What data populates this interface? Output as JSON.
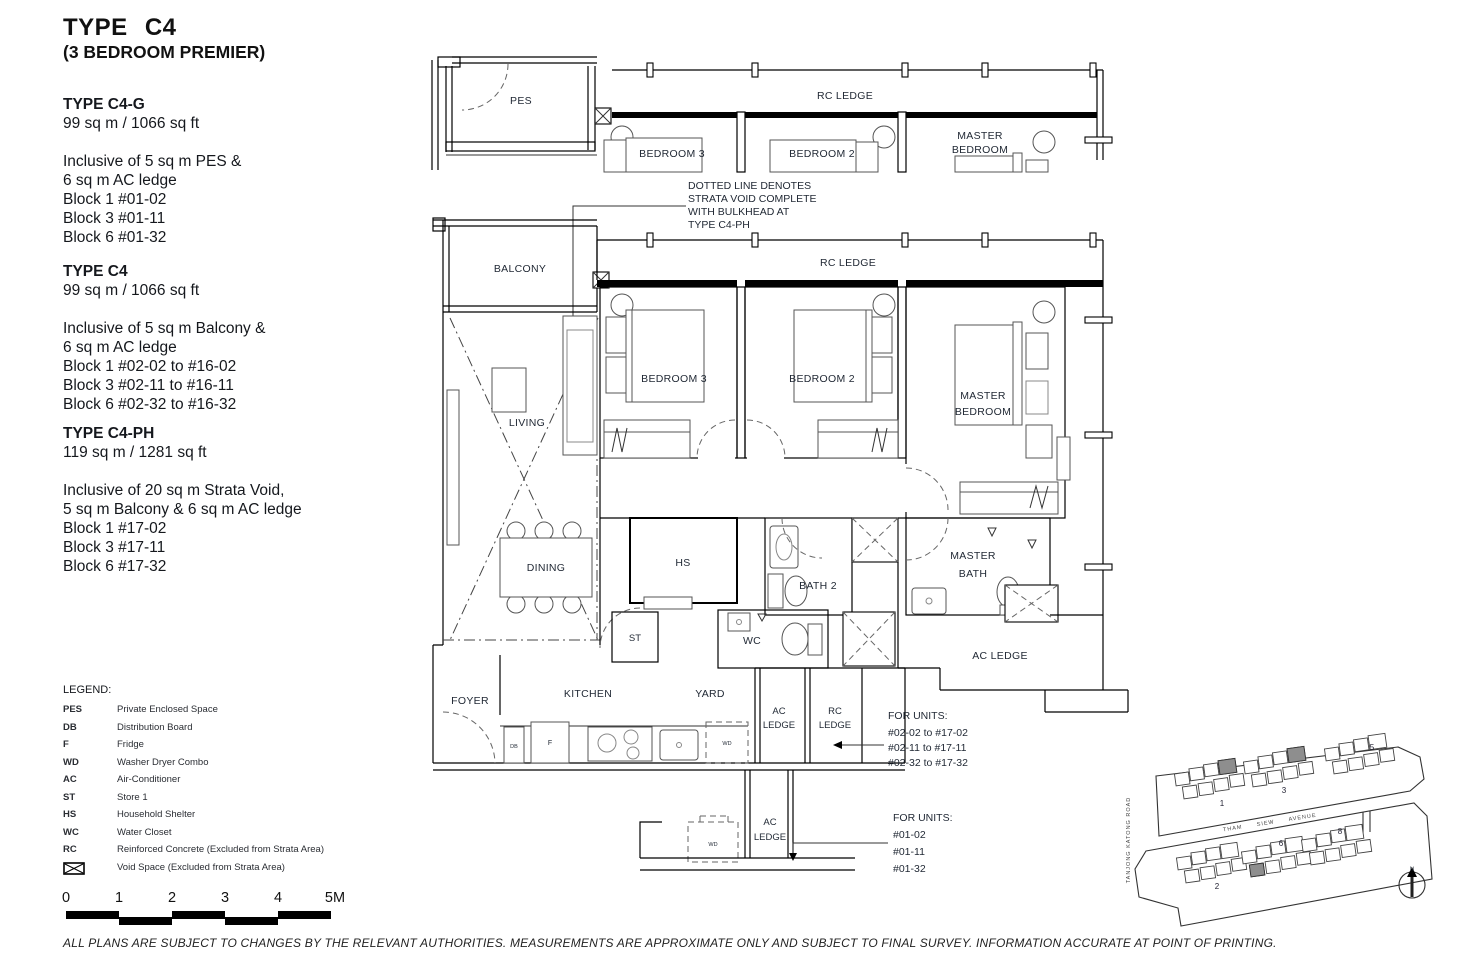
{
  "page": {
    "title": "TYPE C4",
    "subtitle": "(3 BEDROOM PREMIER)"
  },
  "variants": [
    {
      "name": "TYPE C4-G",
      "area": "99 sq m / 1066 sq ft",
      "details": [
        "Inclusive of 5 sq m PES &",
        "6 sq m AC ledge",
        "Block 1 #01-02",
        "Block 3 #01-11",
        "Block 6 #01-32"
      ]
    },
    {
      "name": "TYPE C4",
      "area": "99 sq m / 1066 sq ft",
      "details": [
        "Inclusive of 5 sq m Balcony &",
        "6 sq m AC ledge",
        "Block 1 #02-02 to #16-02",
        "Block 3 #02-11 to #16-11",
        "Block 6 #02-32 to #16-32"
      ]
    },
    {
      "name": "TYPE C4-PH",
      "area": "119 sq m / 1281 sq ft",
      "details": [
        "Inclusive of 20 sq m Strata Void,",
        "5 sq m Balcony & 6 sq m AC ledge",
        "Block 1 #17-02",
        "Block 3 #17-11",
        "Block 6 #17-32"
      ]
    }
  ],
  "legend": {
    "heading": "LEGEND:",
    "items": [
      {
        "abbr": "PES",
        "desc": "Private Enclosed Space"
      },
      {
        "abbr": "DB",
        "desc": "Distribution Board"
      },
      {
        "abbr": "F",
        "desc": "Fridge"
      },
      {
        "abbr": "WD",
        "desc": "Washer Dryer Combo"
      },
      {
        "abbr": "AC",
        "desc": "Air-Conditioner"
      },
      {
        "abbr": "ST",
        "desc": "Store 1"
      },
      {
        "abbr": "HS",
        "desc": "Household Shelter"
      },
      {
        "abbr": "WC",
        "desc": "Water Closet"
      },
      {
        "abbr": "RC",
        "desc": "Reinforced Concrete (Excluded from Strata Area)"
      }
    ],
    "void_desc": "Void Space (Excluded from Strata Area)"
  },
  "scale_bar": {
    "labels": [
      "0",
      "1",
      "2",
      "3",
      "4",
      "5M"
    ]
  },
  "disclaimer": "ALL PLANS ARE SUBJECT TO CHANGES BY THE RELEVANT AUTHORITIES. MEASUREMENTS ARE APPROXIMATE ONLY AND SUBJECT TO FINAL SURVEY. INFORMATION ACCURATE AT POINT OF PRINTING.",
  "plan": {
    "labels": {
      "pes": "PES",
      "balcony": "BALCONY",
      "rc_ledge": "RC LEDGE",
      "bedroom3": "BEDROOM 3",
      "bedroom2": "BEDROOM 2",
      "master1": "MASTER",
      "master2": "BEDROOM",
      "living": "LIVING",
      "dining": "DINING",
      "hs": "HS",
      "bath2": "BATH 2",
      "mbath1": "MASTER",
      "mbath2": "BATH",
      "wc": "WC",
      "st": "ST",
      "ac_ledge": "AC LEDGE",
      "foyer": "FOYER",
      "kitchen": "KITCHEN",
      "yard": "YARD",
      "ac": "AC",
      "rc": "RC",
      "ledge": "LEDGE",
      "db": "DB",
      "f": "F",
      "wd": "WD"
    },
    "strata_note": [
      "DOTTED LINE DENOTES",
      "STRATA VOID COMPLETE",
      "WITH BULKHEAD AT",
      "TYPE C4-PH"
    ],
    "units_note_upper": [
      "FOR UNITS:",
      "#02-02 to #17-02",
      "#02-11 to #17-11",
      "#02-32 to #17-32"
    ],
    "units_note_lower": [
      "FOR UNITS:",
      "#01-02",
      "#01-11",
      "#01-32"
    ]
  },
  "siteplan": {
    "road_left": "TANJONG KATONG ROAD",
    "road_middle": "THAM SIEW AVENUE",
    "blocks": {
      "b1": "1",
      "b2": "2",
      "b3": "3",
      "b5": "5",
      "b6": "6",
      "b8": "8"
    },
    "north": "N"
  }
}
